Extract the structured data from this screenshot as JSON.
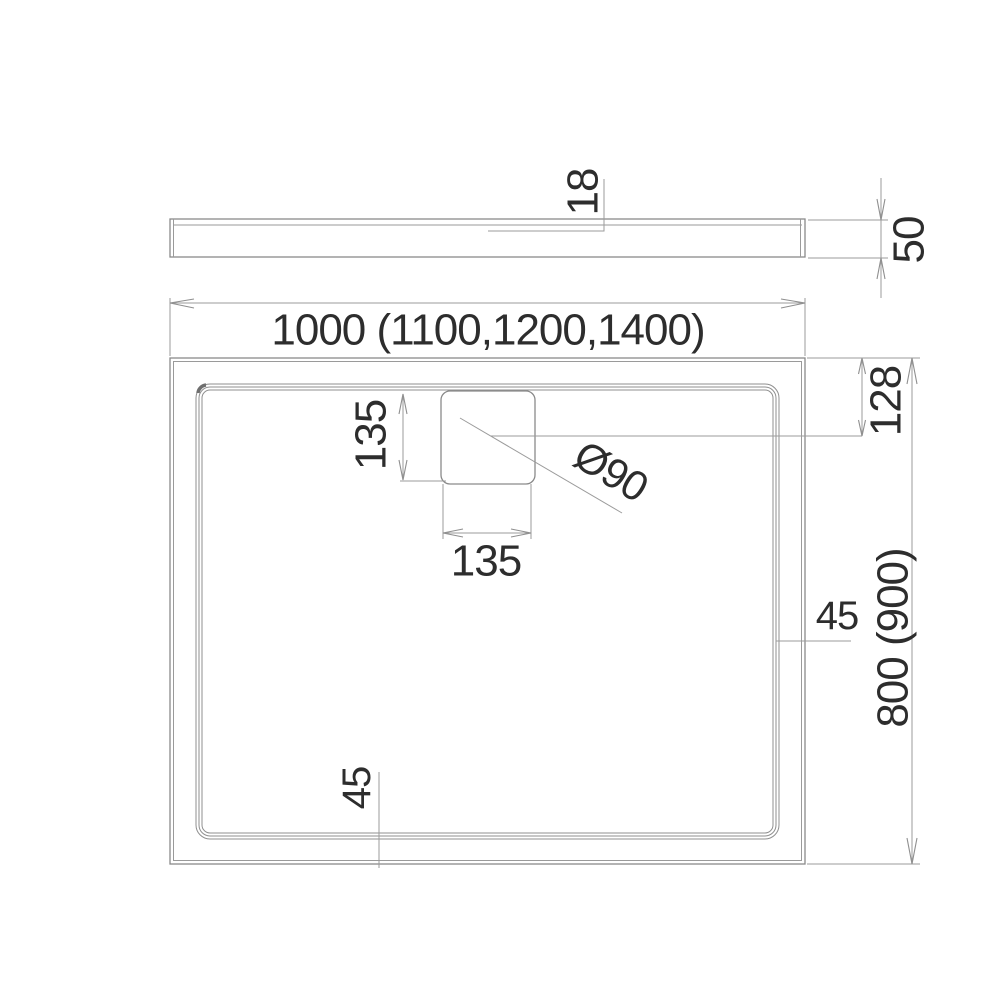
{
  "side_view": {
    "thickness": "18",
    "height": "50"
  },
  "plan_view": {
    "width": "1000 (1100,1200,1400)",
    "depth": "800 (900)",
    "drain_center_offset": "128",
    "drain_length": "135",
    "drain_width": "135",
    "drain_diameter": "Ø90",
    "rim_width_right": "45",
    "rim_width_bottom": "45"
  },
  "colors": {
    "line": "#8a8a8a",
    "dimension_line": "#9b9b9b",
    "text": "#2d2d2d",
    "background": "#ffffff"
  }
}
